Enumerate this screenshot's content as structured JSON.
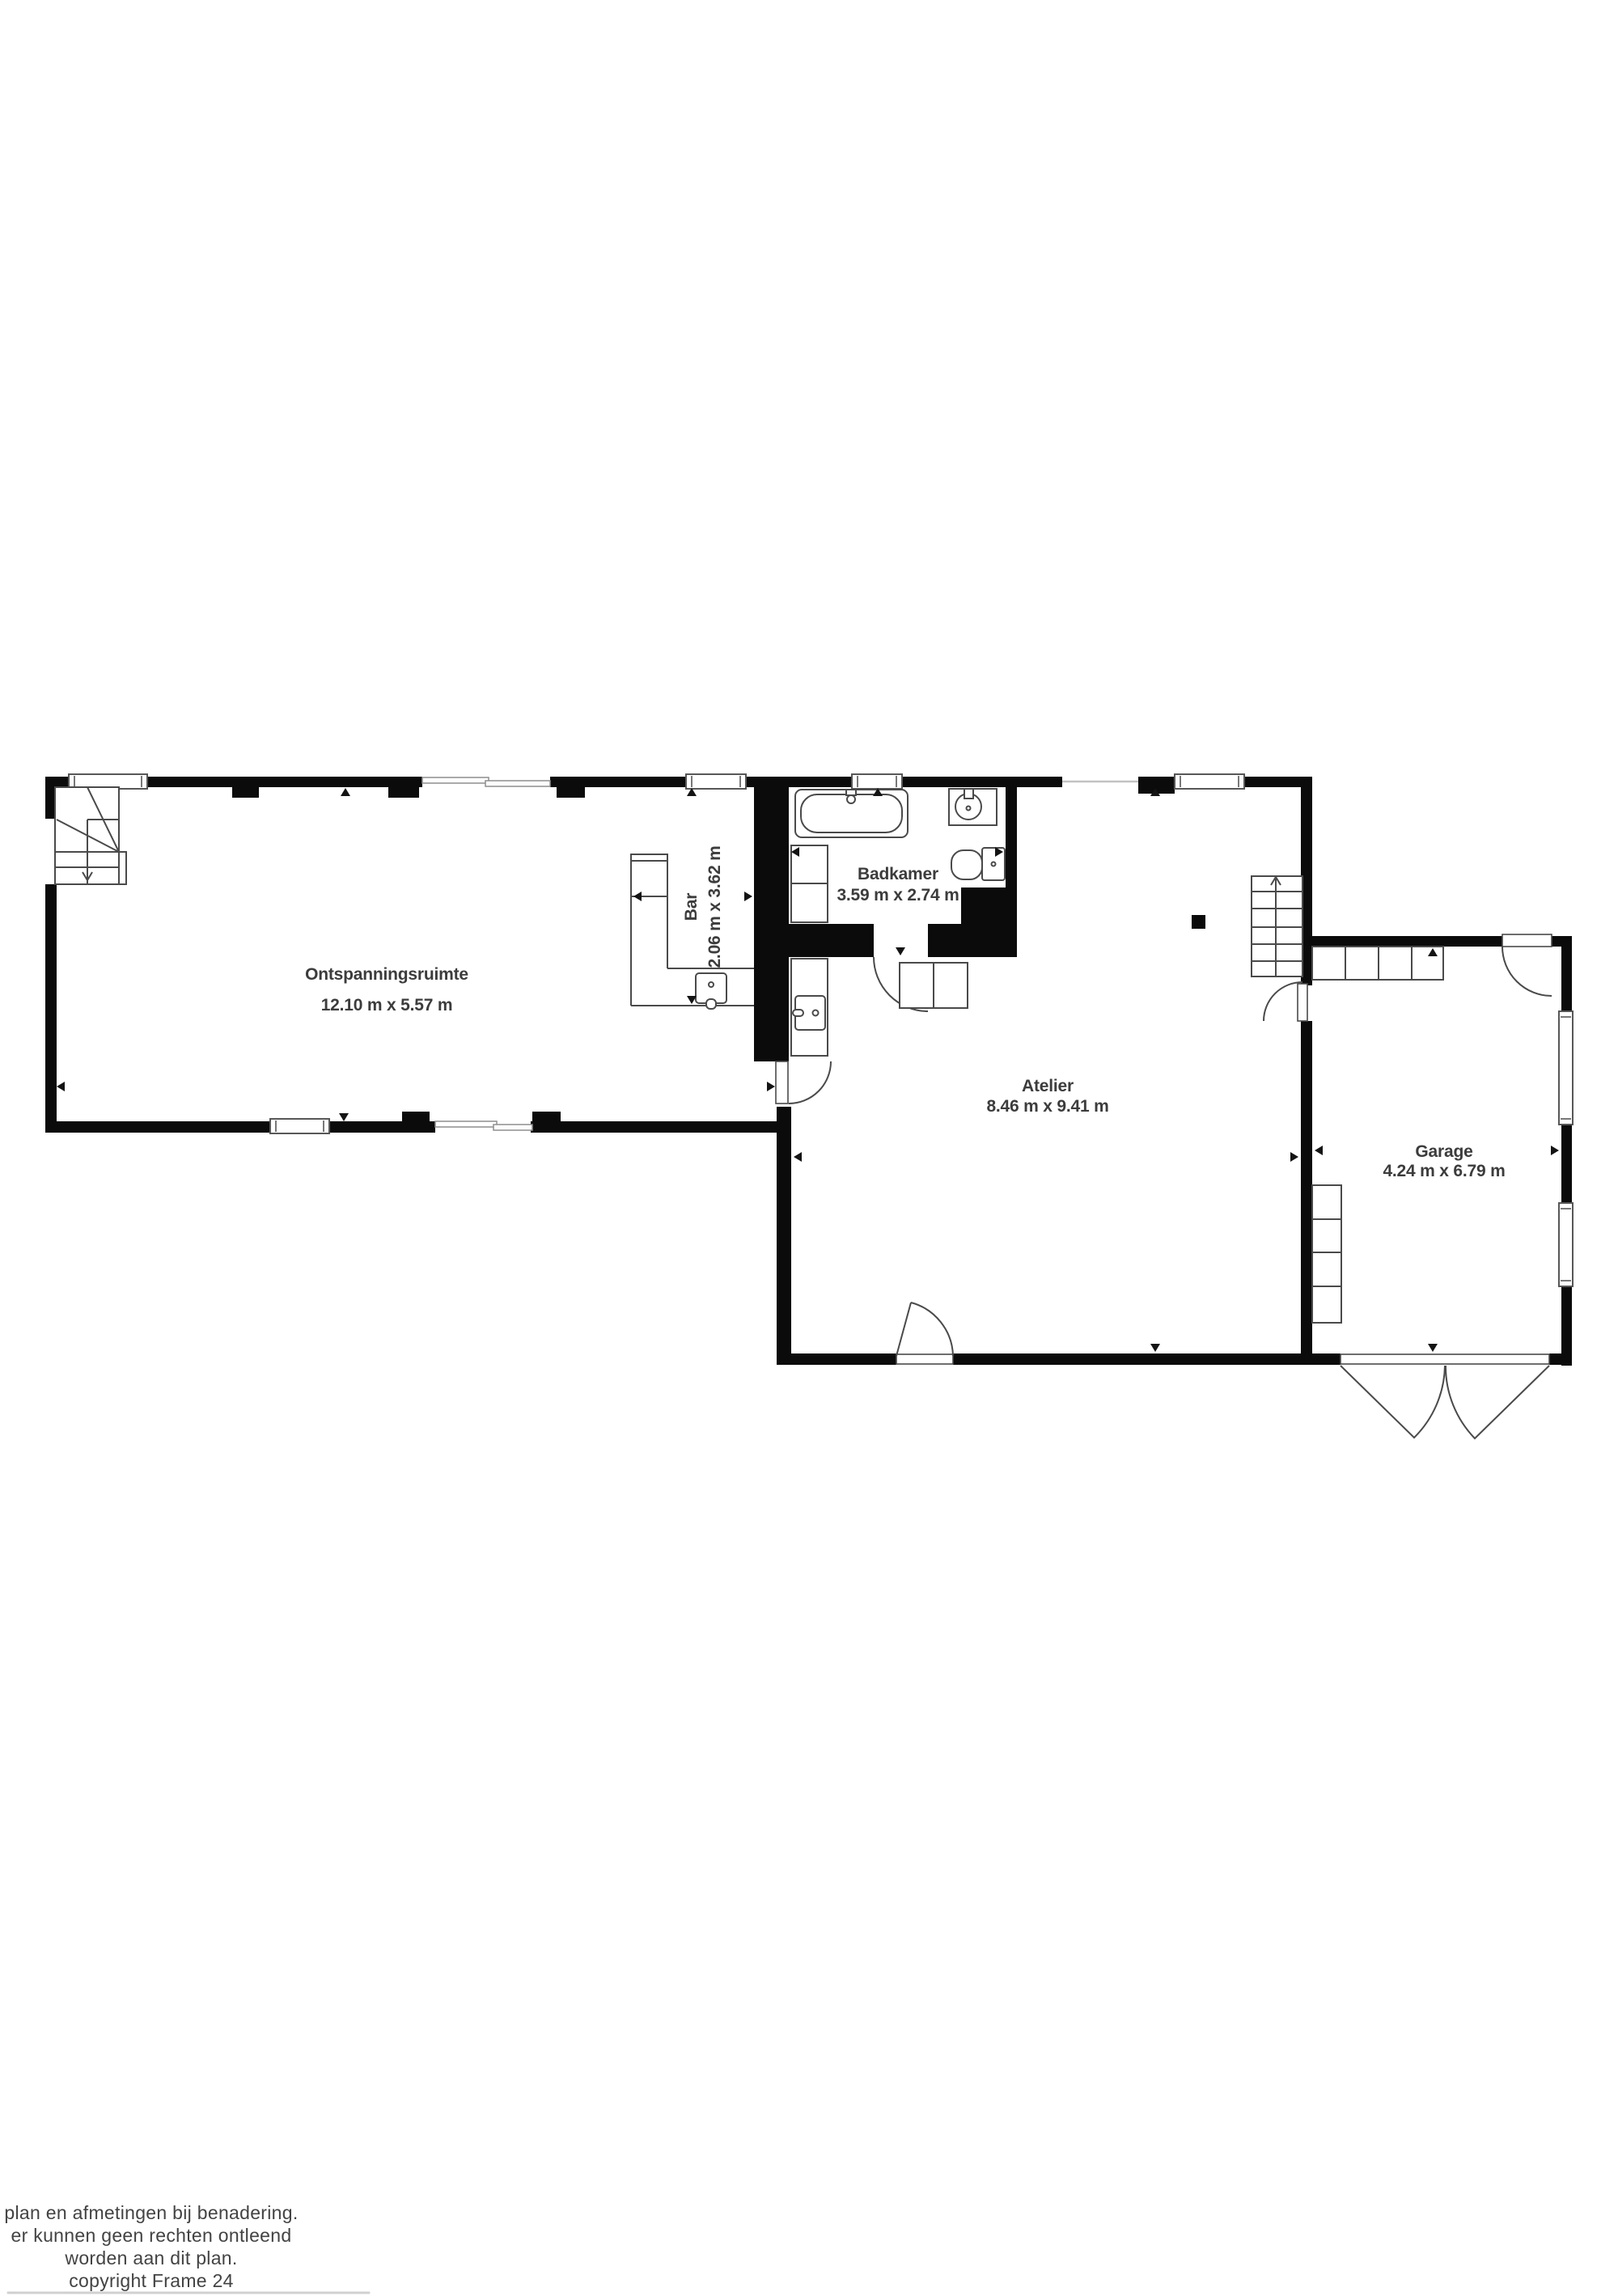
{
  "canvas": {
    "background": "#ffffff",
    "wall_color": "#0b0b0b",
    "fixture_line_color": "#4a4a4a",
    "label_color": "#3c3c3c"
  },
  "rooms": {
    "ontspanningsruimte": {
      "name": "Ontspanningsruimte",
      "dimensions": "12.10 m x 5.57 m"
    },
    "bar": {
      "name": "Bar",
      "dimensions": "2.06 m x 3.62 m"
    },
    "badkamer": {
      "name": "Badkamer",
      "dimensions": "3.59 m x 2.74 m"
    },
    "atelier": {
      "name": "Atelier",
      "dimensions": "8.46 m x 9.41 m"
    },
    "garage": {
      "name": "Garage",
      "dimensions": "4.24 m x 6.79 m"
    }
  },
  "fixtures": [
    "staircase-winder",
    "staircase-straight",
    "bar-counter",
    "bar-sink",
    "kitchen-counter",
    "kitchen-sink",
    "bathtub",
    "bathroom-sink",
    "toilet",
    "shower-cabinet",
    "base-cabinets",
    "garage-cabinets-top",
    "garage-cabinets-left",
    "garage-double-door"
  ],
  "footer": {
    "line1": "plan en afmetingen bij benadering.",
    "line2": "er kunnen geen rechten ontleend",
    "line3": "worden aan dit plan.",
    "line4": "copyright Frame 24"
  }
}
